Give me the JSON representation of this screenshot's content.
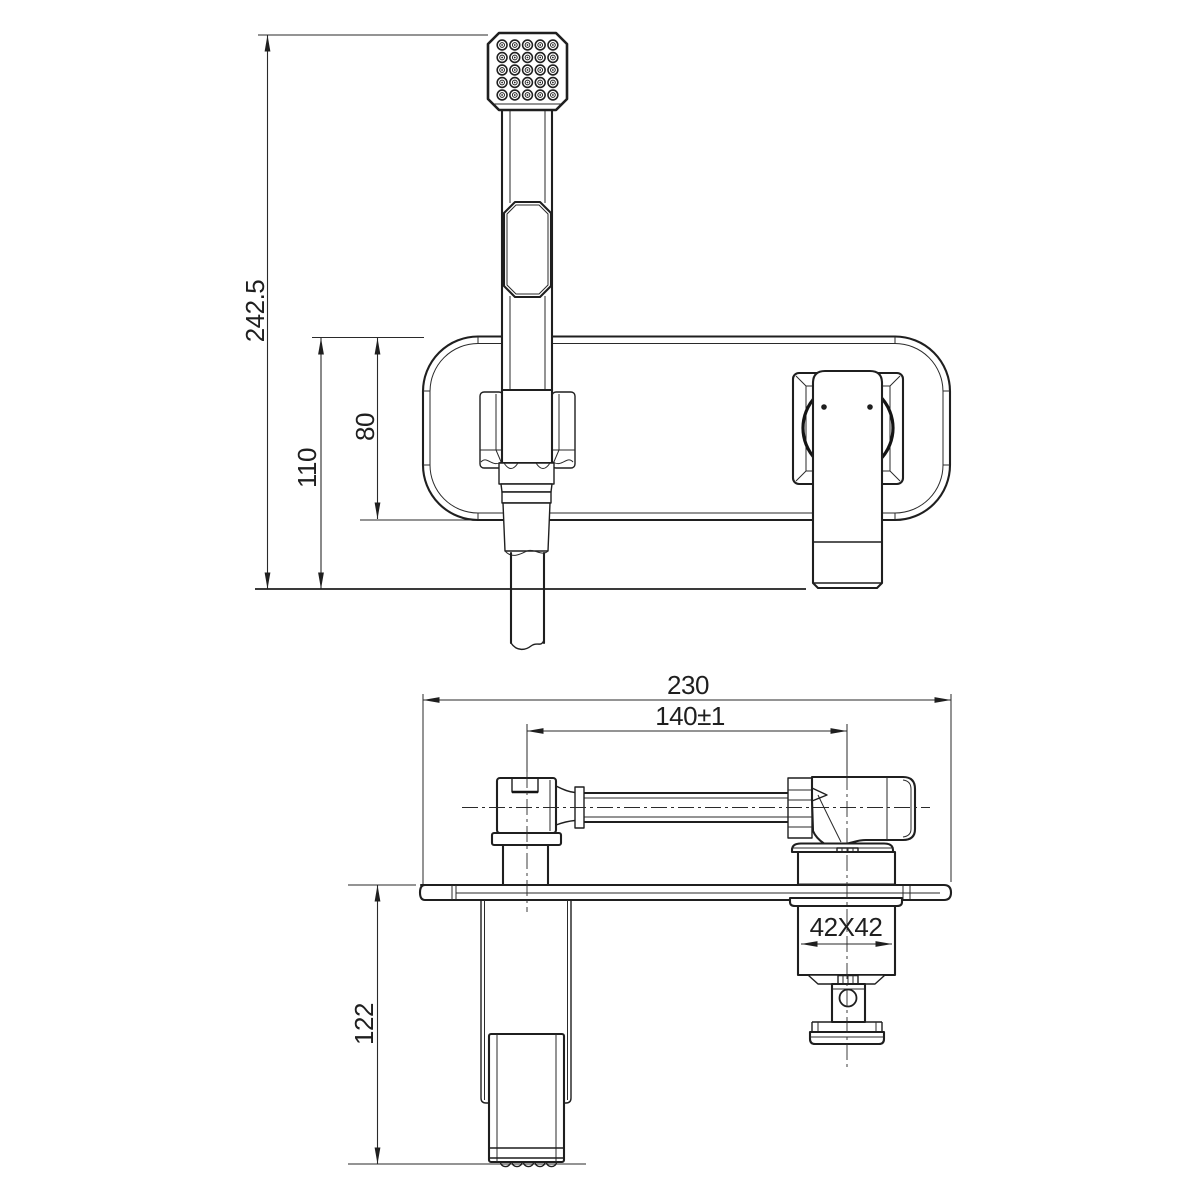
{
  "drawing": {
    "type": "technical-drawing",
    "subject": "wall-mounted mixer with square hand shower, two orthographic views",
    "colors": {
      "background": "#ffffff",
      "line": "#1f1f1f"
    },
    "dimensions": {
      "overall_height": "242.5",
      "plate_offset": "110",
      "plate_height": "80",
      "overall_width": "230",
      "center_distance": "140±1",
      "body_square": "42X42",
      "projection_depth": "122"
    }
  }
}
